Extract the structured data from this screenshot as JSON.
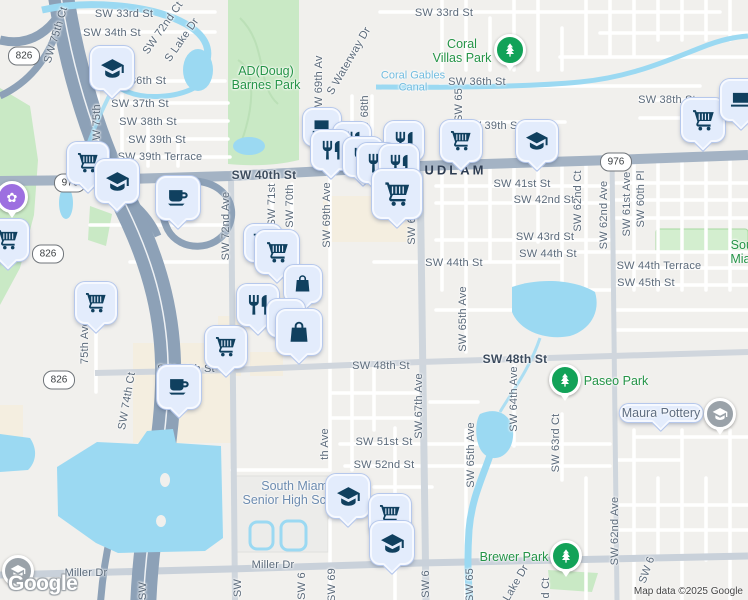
{
  "logo": "Google",
  "attribution": "Map data ©2025 Google",
  "colors": {
    "land": "#f1f0ed",
    "water": "#9bd9f2",
    "park_green": "#c9e9c5",
    "commercial_beige": "#f4eee0",
    "major_road": "#a4b3c4",
    "expressway": "#8da1b7",
    "marker_fill": "#e3ecfc",
    "marker_icon_navy": "#10405f",
    "park_marker_green": "#12a258",
    "gray_marker": "#9aa2a9",
    "purple_marker": "#9d6fe0",
    "park_text_green": "#259447",
    "school_text_blue": "#6d8cb0"
  },
  "icons": {
    "purple_poi_glyph": "✿"
  },
  "shields": [
    {
      "route": "826",
      "x": 24,
      "y": 56
    },
    {
      "route": "976",
      "x": 70,
      "y": 183
    },
    {
      "route": "826",
      "x": 48,
      "y": 254
    },
    {
      "route": "826",
      "x": 59,
      "y": 380
    },
    {
      "route": "976",
      "x": 616,
      "y": 162
    }
  ],
  "street_labels": [
    {
      "t": "SW 33rd St",
      "x": 124,
      "y": 14
    },
    {
      "t": "SW 33rd St",
      "x": 444,
      "y": 13
    },
    {
      "t": "SW 34th St",
      "x": 112,
      "y": 33
    },
    {
      "t": "36th St",
      "x": 148,
      "y": 81
    },
    {
      "t": "SW 36th St",
      "x": 477,
      "y": 82
    },
    {
      "t": "SW 37th St",
      "x": 140,
      "y": 104
    },
    {
      "t": "SW 38th St",
      "x": 148,
      "y": 122
    },
    {
      "t": "SW 38th St",
      "x": 667,
      "y": 100
    },
    {
      "t": "SW 39th St",
      "x": 157,
      "y": 140
    },
    {
      "t": "SW 39th St",
      "x": 492,
      "y": 126
    },
    {
      "t": "SW 39th Terrace",
      "x": 160,
      "y": 157
    },
    {
      "t": "SW 40th St",
      "x": 264,
      "y": 175,
      "major": true
    },
    {
      "t": "LUDLAM",
      "x": 450,
      "y": 170,
      "road": true
    },
    {
      "t": "SW 41st St",
      "x": 522,
      "y": 184
    },
    {
      "t": "SW 42nd St",
      "x": 544,
      "y": 200
    },
    {
      "t": "SW 43rd St",
      "x": 545,
      "y": 237
    },
    {
      "t": "SW 44th St",
      "x": 454,
      "y": 263
    },
    {
      "t": "SW 44th St",
      "x": 548,
      "y": 254
    },
    {
      "t": "SW 44th Terrace",
      "x": 659,
      "y": 266
    },
    {
      "t": "SW 45th St",
      "x": 646,
      "y": 283
    },
    {
      "t": "SW 48th St",
      "x": 186,
      "y": 369
    },
    {
      "t": "SW 48th St",
      "x": 381,
      "y": 366
    },
    {
      "t": "SW 48th St",
      "x": 515,
      "y": 359,
      "major": true
    },
    {
      "t": "SW 51st St",
      "x": 384,
      "y": 442
    },
    {
      "t": "SW 52nd St",
      "x": 384,
      "y": 465
    },
    {
      "t": "Miller Dr",
      "x": 86,
      "y": 573
    },
    {
      "t": "Miller Dr",
      "x": 273,
      "y": 565
    },
    {
      "t": "SW 75th Ct",
      "x": 56,
      "y": 35,
      "r": -73
    },
    {
      "t": "SW 72nd Ct",
      "x": 163,
      "y": 28,
      "r": -55
    },
    {
      "t": "S Lake Dr",
      "x": 182,
      "y": 40,
      "r": -55
    },
    {
      "t": "SW 75th",
      "x": 97,
      "y": 126,
      "r": -90
    },
    {
      "t": "S Waterway Dr",
      "x": 349,
      "y": 61,
      "r": -60
    },
    {
      "t": "SW 69th Av",
      "x": 319,
      "y": 85,
      "r": -90
    },
    {
      "t": "SW 68th",
      "x": 365,
      "y": 117,
      "r": -90
    },
    {
      "t": "SW 65",
      "x": 459,
      "y": 105,
      "r": -90
    },
    {
      "t": "SW 72nd Ave",
      "x": 226,
      "y": 226,
      "r": -90
    },
    {
      "t": "SW 71st",
      "x": 272,
      "y": 205,
      "r": -90
    },
    {
      "t": "SW 70th",
      "x": 290,
      "y": 206,
      "r": -90
    },
    {
      "t": "SW 69th Ave",
      "x": 327,
      "y": 215,
      "r": -90
    },
    {
      "t": "SW 67th Ave",
      "x": 412,
      "y": 212,
      "r": -90
    },
    {
      "t": "SW 62nd Ct",
      "x": 578,
      "y": 201,
      "r": -90
    },
    {
      "t": "SW 62nd Ave",
      "x": 604,
      "y": 215,
      "r": -90
    },
    {
      "t": "SW 61st Ave",
      "x": 627,
      "y": 204,
      "r": -90
    },
    {
      "t": "SW 60th Pl",
      "x": 641,
      "y": 199,
      "r": -90
    },
    {
      "t": "75th Ave",
      "x": 85,
      "y": 342,
      "r": -90
    },
    {
      "t": "SW 74th Ct",
      "x": 127,
      "y": 401,
      "r": -80
    },
    {
      "t": "SW 65th Ave",
      "x": 463,
      "y": 319,
      "r": -90
    },
    {
      "t": "SW 64th Ave",
      "x": 514,
      "y": 399,
      "r": -90
    },
    {
      "t": "SW 67th Ave",
      "x": 419,
      "y": 406,
      "r": -90
    },
    {
      "t": "th Ave",
      "x": 325,
      "y": 444,
      "r": -90
    },
    {
      "t": "SW 63rd Ct",
      "x": 556,
      "y": 443,
      "r": -90
    },
    {
      "t": "SW 65th Ave",
      "x": 471,
      "y": 455,
      "r": -90
    },
    {
      "t": "SW 62nd Ave",
      "x": 615,
      "y": 531,
      "r": -90
    },
    {
      "t": "Lake Dr",
      "x": 516,
      "y": 583,
      "r": -60
    },
    {
      "t": "d Ct",
      "x": 546,
      "y": 588,
      "r": -90
    },
    {
      "t": "SW 6",
      "x": 647,
      "y": 570,
      "r": -70
    },
    {
      "t": "SW",
      "x": 143,
      "y": 591,
      "r": -90
    },
    {
      "t": "SW",
      "x": 238,
      "y": 588,
      "r": -90
    },
    {
      "t": "SW 6",
      "x": 302,
      "y": 586,
      "r": -90
    },
    {
      "t": "SW 69",
      "x": 332,
      "y": 585,
      "r": -90
    },
    {
      "t": "SW 6",
      "x": 426,
      "y": 584,
      "r": -90
    },
    {
      "t": "SW 65",
      "x": 470,
      "y": 585,
      "r": -90
    }
  ],
  "place_labels": [
    {
      "lines": [
        "AD(Doug)",
        "Barnes Park"
      ],
      "x": 266,
      "y": 78,
      "cls": "park"
    },
    {
      "lines": [
        "Coral",
        "Villas Park"
      ],
      "x": 462,
      "y": 51,
      "cls": "park"
    },
    {
      "lines": [
        "Coral Gables",
        "Canal"
      ],
      "x": 413,
      "y": 82,
      "cls": "water"
    },
    {
      "lines": [
        "Paseo Park"
      ],
      "x": 616,
      "y": 381,
      "cls": "park"
    },
    {
      "lines": [
        "Brewer Park"
      ],
      "x": 514,
      "y": 557,
      "cls": "park"
    },
    {
      "lines": [
        "South",
        "Miami"
      ],
      "x": 747,
      "y": 252,
      "cls": "park"
    },
    {
      "lines": [
        "Maura Pottery"
      ],
      "x": 661,
      "y": 413,
      "cls": "poi"
    },
    {
      "lines": [
        "South Miami",
        "Senior High School"
      ],
      "x": 296,
      "y": 493,
      "cls": "school"
    }
  ],
  "markers": [
    {
      "type": "school",
      "x": 112,
      "y": 68,
      "s": 40
    },
    {
      "type": "cart",
      "x": 88,
      "y": 163,
      "s": 38
    },
    {
      "type": "school",
      "x": 117,
      "y": 181,
      "s": 40
    },
    {
      "type": "coffee",
      "x": 178,
      "y": 198,
      "s": 40
    },
    {
      "type": "cart",
      "x": 8,
      "y": 240,
      "s": 38
    },
    {
      "type": "cart",
      "x": 96,
      "y": 303,
      "s": 38
    },
    {
      "type": "coffee",
      "x": 179,
      "y": 387,
      "s": 40
    },
    {
      "type": "cart",
      "x": 226,
      "y": 347,
      "s": 38
    },
    {
      "type": "cart",
      "x": 263,
      "y": 243,
      "s": 34
    },
    {
      "type": "cart",
      "x": 277,
      "y": 252,
      "s": 40
    },
    {
      "type": "bag",
      "x": 303,
      "y": 284,
      "s": 34
    },
    {
      "type": "restaurant",
      "x": 258,
      "y": 305,
      "s": 38
    },
    {
      "type": "bag",
      "x": 286,
      "y": 318,
      "s": 34
    },
    {
      "type": "bag",
      "x": 299,
      "y": 332,
      "s": 42
    },
    {
      "type": "laptop",
      "x": 322,
      "y": 127,
      "s": 34
    },
    {
      "type": "restaurant",
      "x": 352,
      "y": 141,
      "s": 34
    },
    {
      "type": "restaurant",
      "x": 331,
      "y": 150,
      "s": 36
    },
    {
      "type": "restaurant",
      "x": 404,
      "y": 141,
      "s": 36
    },
    {
      "type": "restaurant",
      "x": 363,
      "y": 157,
      "s": 36
    },
    {
      "type": "restaurant",
      "x": 377,
      "y": 163,
      "s": 36
    },
    {
      "type": "restaurant",
      "x": 399,
      "y": 164,
      "s": 36
    },
    {
      "type": "cart",
      "x": 461,
      "y": 141,
      "s": 38
    },
    {
      "type": "school",
      "x": 537,
      "y": 141,
      "s": 38
    },
    {
      "type": "cart",
      "x": 397,
      "y": 194,
      "s": 46
    },
    {
      "type": "cart",
      "x": 703,
      "y": 120,
      "s": 40
    },
    {
      "type": "laptop",
      "x": 741,
      "y": 100,
      "s": 38
    },
    {
      "type": "school",
      "x": 348,
      "y": 496,
      "s": 40
    },
    {
      "type": "cart",
      "x": 390,
      "y": 515,
      "s": 38
    },
    {
      "type": "school",
      "x": 392,
      "y": 543,
      "s": 40
    }
  ],
  "circle_markers": [
    {
      "type": "park",
      "x": 510,
      "y": 50
    },
    {
      "type": "park",
      "x": 565,
      "y": 380
    },
    {
      "type": "park",
      "x": 566,
      "y": 556
    },
    {
      "type": "museum",
      "x": 18,
      "y": 571
    },
    {
      "type": "museum",
      "x": 720,
      "y": 414
    },
    {
      "type": "purple",
      "x": 12,
      "y": 197
    }
  ]
}
